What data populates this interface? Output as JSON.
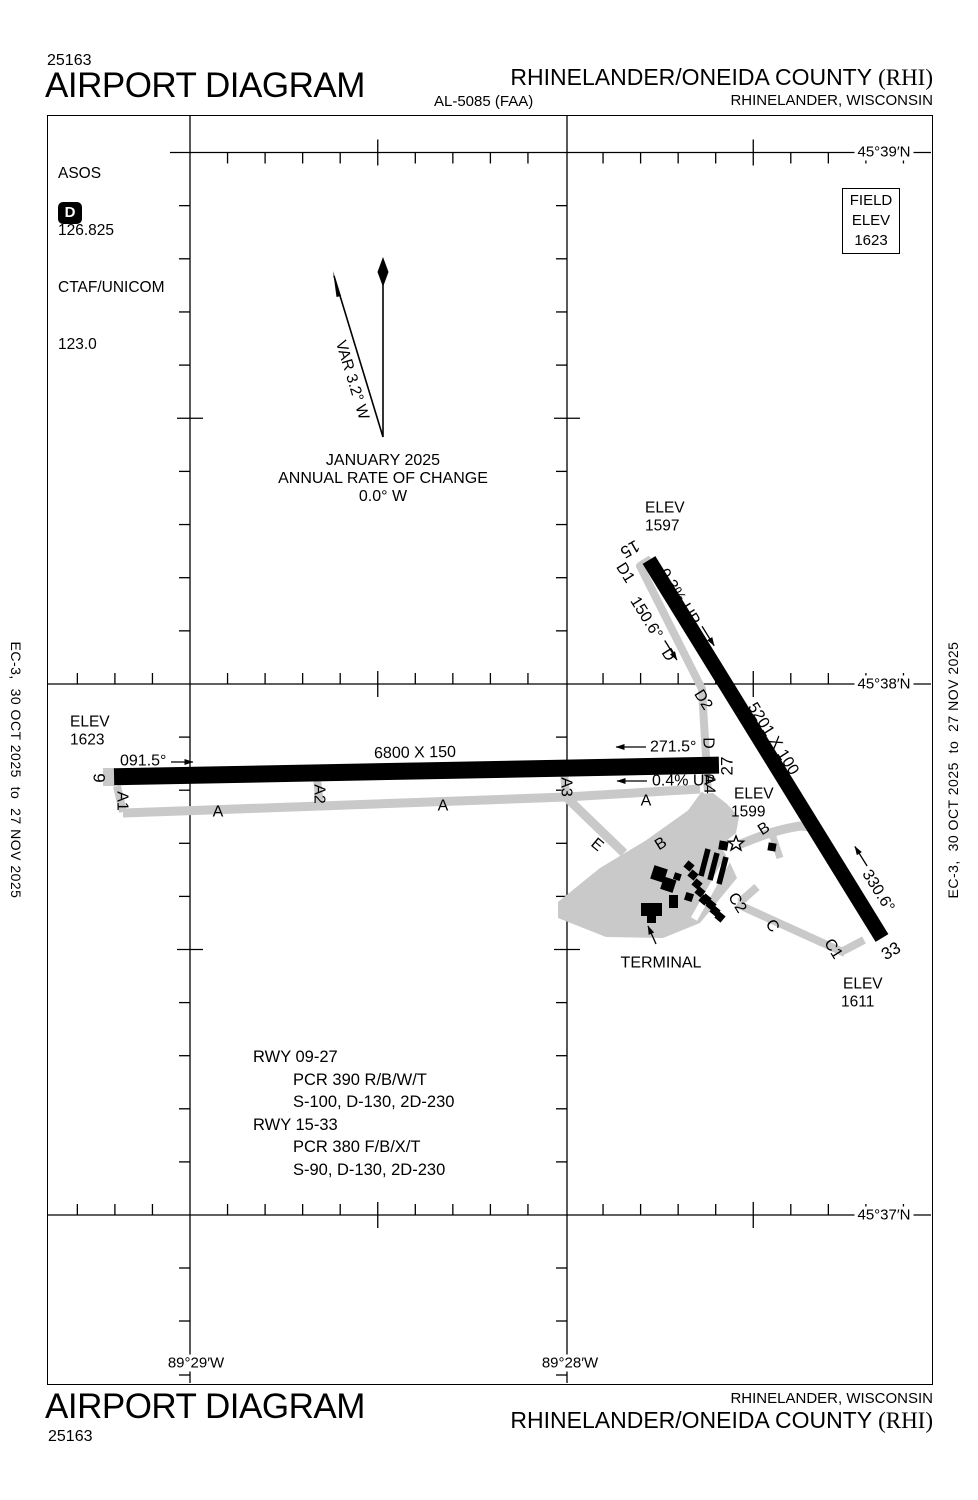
{
  "header": {
    "chart_number": "25163",
    "title": "AIRPORT DIAGRAM",
    "al_number": "AL-5085 (FAA)",
    "airport_name": "RHINELANDER/ONEIDA COUNTY",
    "airport_id": "(RHI)",
    "city": "RHINELANDER, WISCONSIN"
  },
  "footer": {
    "chart_number": "25163",
    "title": "AIRPORT DIAGRAM",
    "airport_name": "RHINELANDER/ONEIDA COUNTY",
    "airport_id": "(RHI)",
    "city": "RHINELANDER, WISCONSIN"
  },
  "edge_note": "EC-3,  30 OCT 2025  to  27 NOV 2025",
  "comm_box": {
    "asos_label": "ASOS",
    "asos_freq": "126.825",
    "ctaf_label": "CTAF/UNICOM",
    "ctaf_freq": "123.0",
    "d_badge": "D"
  },
  "field_elev_box": {
    "line1": "FIELD",
    "line2": "ELEV",
    "value": "1623"
  },
  "compass": {
    "variation": "VAR 3.2° W",
    "date": "JANUARY 2025",
    "rate_label": "ANNUAL RATE OF CHANGE",
    "rate_value": "0.0° W"
  },
  "graticule": {
    "lat_39": "45°39′N",
    "lat_38": "45°38′N",
    "lat_37": "45°37′N",
    "lon_29": "89°29′W",
    "lon_28": "89°28′W"
  },
  "runway_09_27": {
    "end_09": "9",
    "end_27": "27",
    "dimensions": "6800 X 150",
    "heading_09": "091.5°",
    "heading_27": "271.5°",
    "gradient": "0.4% UP",
    "elev_label": "ELEV",
    "elev_09": "1623",
    "elev_27": "1599"
  },
  "runway_15_33": {
    "end_15": "15",
    "end_33": "33",
    "dimensions": "5201 X 100",
    "heading_15": "150.6°",
    "heading_33": "330.6°",
    "gradient": "0.3% UP",
    "elev_label": "ELEV",
    "elev_15": "1597",
    "elev_33": "1611"
  },
  "taxiways": {
    "a": "A",
    "a1": "A1",
    "a2": "A2",
    "a3": "A3",
    "a4": "A4",
    "b": "B",
    "c": "C",
    "c1": "C1",
    "c2": "C2",
    "d": "D",
    "d1": "D1",
    "d2": "D2",
    "e": "E"
  },
  "terminal_label": "TERMINAL",
  "runway_data_block": {
    "rwy1": "RWY 09-27",
    "rwy1_pcr": "PCR 390 R/B/W/T",
    "rwy1_codes": "S-100, D-130, 2D-230",
    "rwy2": "RWY 15-33",
    "rwy2_pcr": "PCR 380 F/B/X/T",
    "rwy2_codes": "S-90, D-130, 2D-230"
  },
  "colors": {
    "taxiway": "#c9c9c9",
    "runway": "#000000"
  }
}
